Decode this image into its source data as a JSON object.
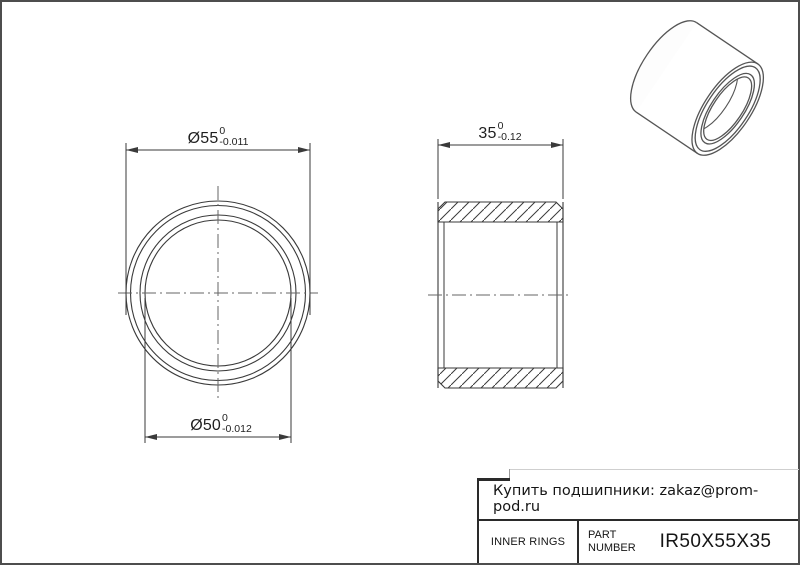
{
  "dimensions": {
    "outer_diameter": {
      "value": "Ø55",
      "tol_upper": "0",
      "tol_lower": "-0.011"
    },
    "bore_diameter": {
      "value": "Ø50",
      "tol_upper": "0",
      "tol_lower": "-0.012"
    },
    "width": {
      "value": "35",
      "tol_upper": "0",
      "tol_lower": "-0.12"
    }
  },
  "title_block": {
    "contact": "Купить подшипники: zakaz@prom-pod.ru",
    "category": "INNER RINGS",
    "part_number_label": "PART NUMBER",
    "part_number": "IR50X55X35"
  },
  "colors": {
    "line": "#3a3a3a",
    "centerline": "#666666",
    "frame": "#4d4d4d",
    "text": "#1a1a1a"
  }
}
